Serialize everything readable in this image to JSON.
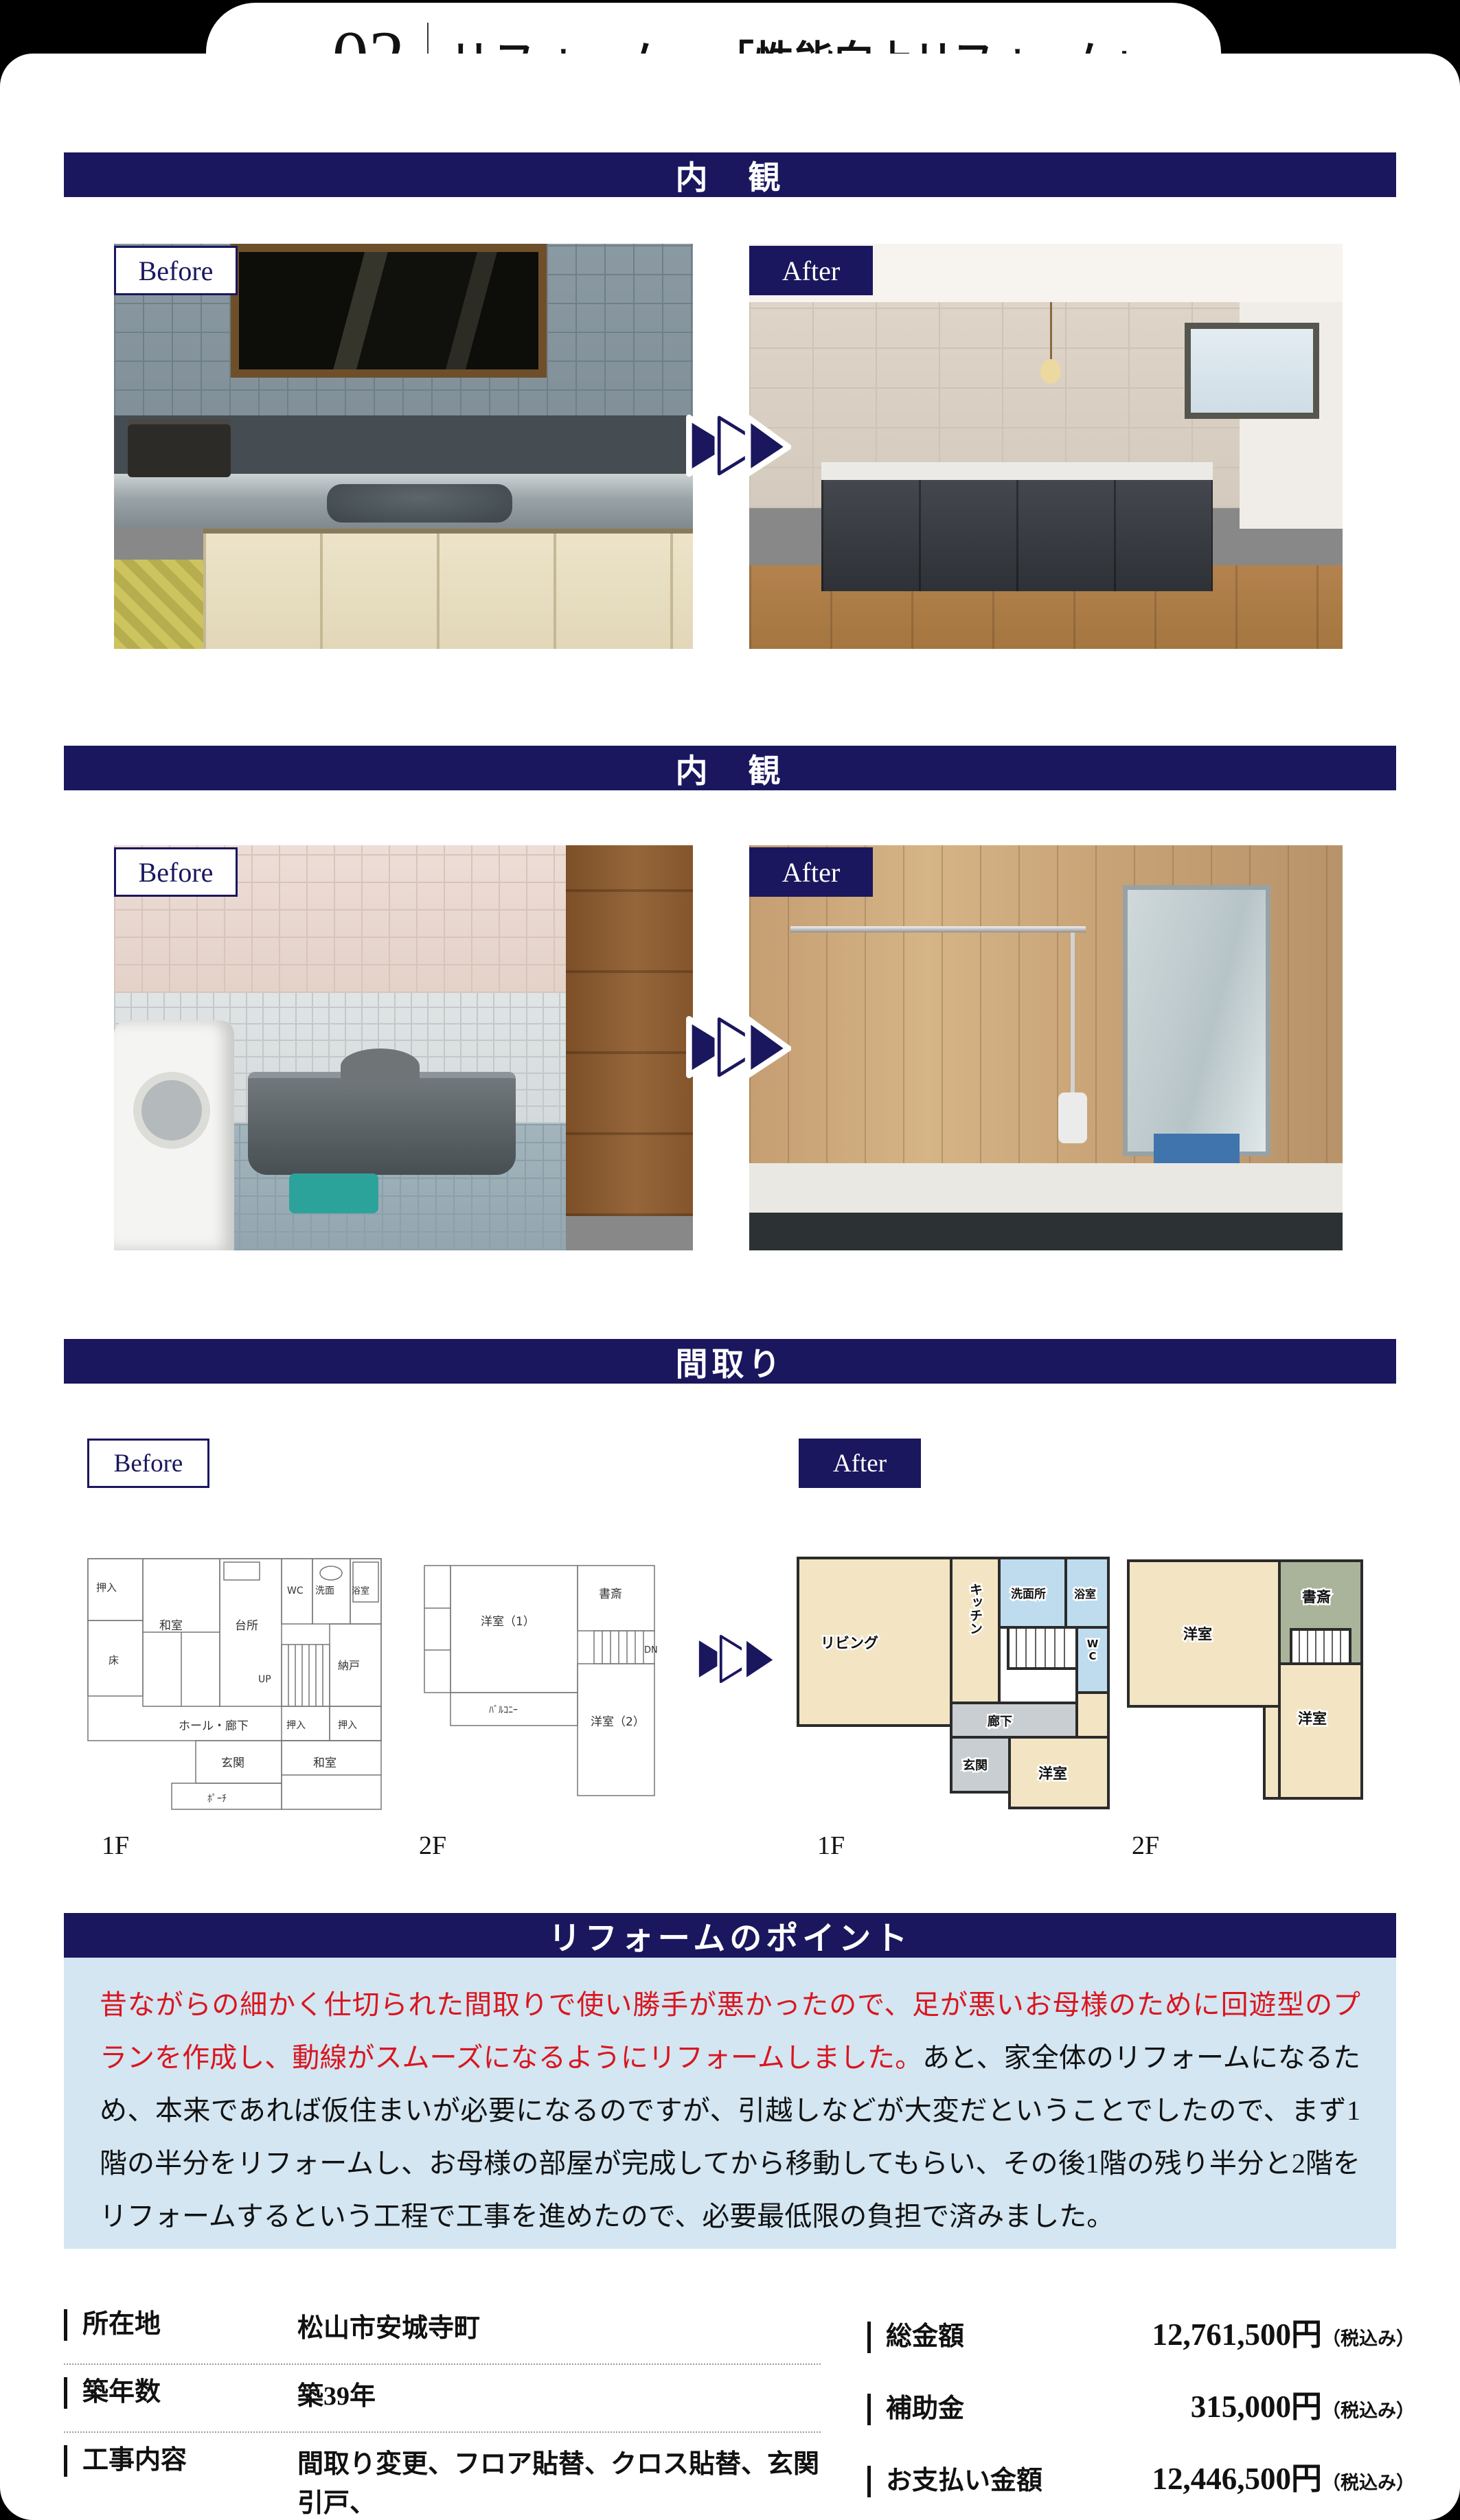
{
  "header": {
    "case_label": "case",
    "case_number": "02",
    "title": "リフォーム",
    "subtitle": "「性能向上リフォーム」"
  },
  "sections": {
    "interior1": "内　観",
    "interior2": "内　観",
    "floorplan": "間取り",
    "points": "リフォームのポイント"
  },
  "labels": {
    "before": "Before",
    "after": "After"
  },
  "floorplan": {
    "captions": {
      "before_1f": "1F",
      "before_2f": "2F",
      "after_1f": "1F",
      "after_2f": "2F"
    },
    "before_1f": {
      "oshiire_tl": "押入",
      "toko": "床",
      "washitsu": "和室",
      "daidokoro": "台所",
      "wc": "WC",
      "senmen": "洗面",
      "yokushitsu": "浴室",
      "up": "UP",
      "nando": "納戸",
      "hall": "ホール・廊下",
      "oshiire_c": "押入",
      "oshiire_r": "押入",
      "genkan": "玄関",
      "washitsu_b": "和室",
      "porch": "ﾎﾟｰﾁ"
    },
    "before_2f": {
      "youshitsu1": "洋室（1）",
      "shosai": "書斎",
      "dn": "DN",
      "balcony": "ﾊﾞﾙｺﾆｰ",
      "youshitsu2": "洋室（2）"
    },
    "after_1f": {
      "living": "リビング",
      "kitchen": "キッチン",
      "senmenjo": "洗面所",
      "yokushitsu": "浴室",
      "wc": "WC",
      "rouka": "廊下",
      "genkan": "玄関",
      "youshitsu": "洋室"
    },
    "after_2f": {
      "youshitsu1": "洋室",
      "shosai": "書斎",
      "youshitsu2": "洋室"
    }
  },
  "points": {
    "highlight": "昔ながらの細かく仕切られた間取りで使い勝手が悪かったので、足が悪いお母様のために回遊型のプランを作成し、動線がスムーズになるようにリフォームしました。",
    "body": "あと、家全体のリフォームになるため、本来であれば仮住まいが必要になるのですが、引越しなどが大変だということでしたので、まず1階の半分をリフォームし、お母様の部屋が完成してから移動してもらい、その後1階の残り半分と2階をリフォームするという工程で工事を進めたので、必要最低限の負担で済みました。"
  },
  "details": {
    "left": [
      {
        "label": "所在地",
        "value": "松山市安城寺町"
      },
      {
        "label": "築年数",
        "value": "築39年"
      },
      {
        "label": "工事内容",
        "value": "間取り変更、フロア貼替、クロス貼替、玄関引戸、\n水廻り設備一式、サッシ交換、外構"
      }
    ],
    "right": [
      {
        "label": "総金額",
        "amount": "12,761,500円",
        "tax": "（税込み）"
      },
      {
        "label": "補助金",
        "amount": "315,000円",
        "tax": "（税込み）"
      },
      {
        "label": "お支払い金額",
        "amount": "12,446,500円",
        "tax": "（税込み）"
      }
    ]
  },
  "colors": {
    "navy": "#1a175e",
    "red": "#d9161f",
    "light_blue": "#d3e6f2",
    "plan_cream": "#f3e5c3",
    "plan_blue": "#bedcee",
    "plan_gray": "#c9ced2",
    "plan_green": "#a9b49a"
  }
}
